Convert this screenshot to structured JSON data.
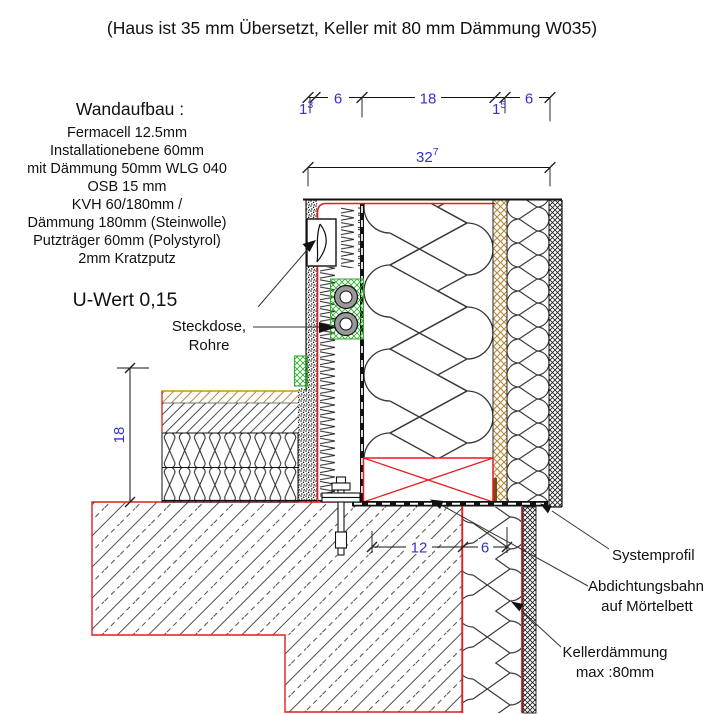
{
  "title": "(Haus ist 35 mm Übersetzt, Keller mit 80 mm Dämmung W035)",
  "wall_spec": {
    "heading": "Wandaufbau :",
    "layers": [
      "Fermacell 12.5mm",
      "Installationebene 60mm",
      "mit Dämmung 50mm WLG 040",
      "OSB 15 mm",
      "KVH 60/180mm /",
      "Dämmung 180mm (Steinwolle)",
      "Putzträger 60mm (Polystyrol)",
      "2mm Kratzputz"
    ],
    "u_value": "U-Wert 0,15"
  },
  "annotations": {
    "steckdose_line1": "Steckdose,",
    "steckdose_line2": "Rohre",
    "systemprofil": "Systemprofil",
    "abdichtung_line1": "Abdichtungsbahn",
    "abdichtung_line2": "auf Mörtelbett",
    "keller_line1": "Kellerdämmung",
    "keller_line2": "max :80mm"
  },
  "dims": {
    "seg1_base": "1",
    "seg1_sup": "3",
    "seg2": "6",
    "seg3": "18",
    "seg4_base": "1",
    "seg4_sup": "5",
    "seg5": "6",
    "total_base": "32",
    "total_sup": "7",
    "floor_height": "18",
    "keller_wall": "12",
    "keller_insulation": "6"
  },
  "colors": {
    "redline": "#e31e1e",
    "dim_blue": "#3232cd",
    "tan": "#b5893c",
    "tan_border": "#c8960c",
    "brown": "#7a4a10",
    "green": "#2fae2f",
    "pipe_gray": "#999999",
    "ink": "#111111"
  }
}
